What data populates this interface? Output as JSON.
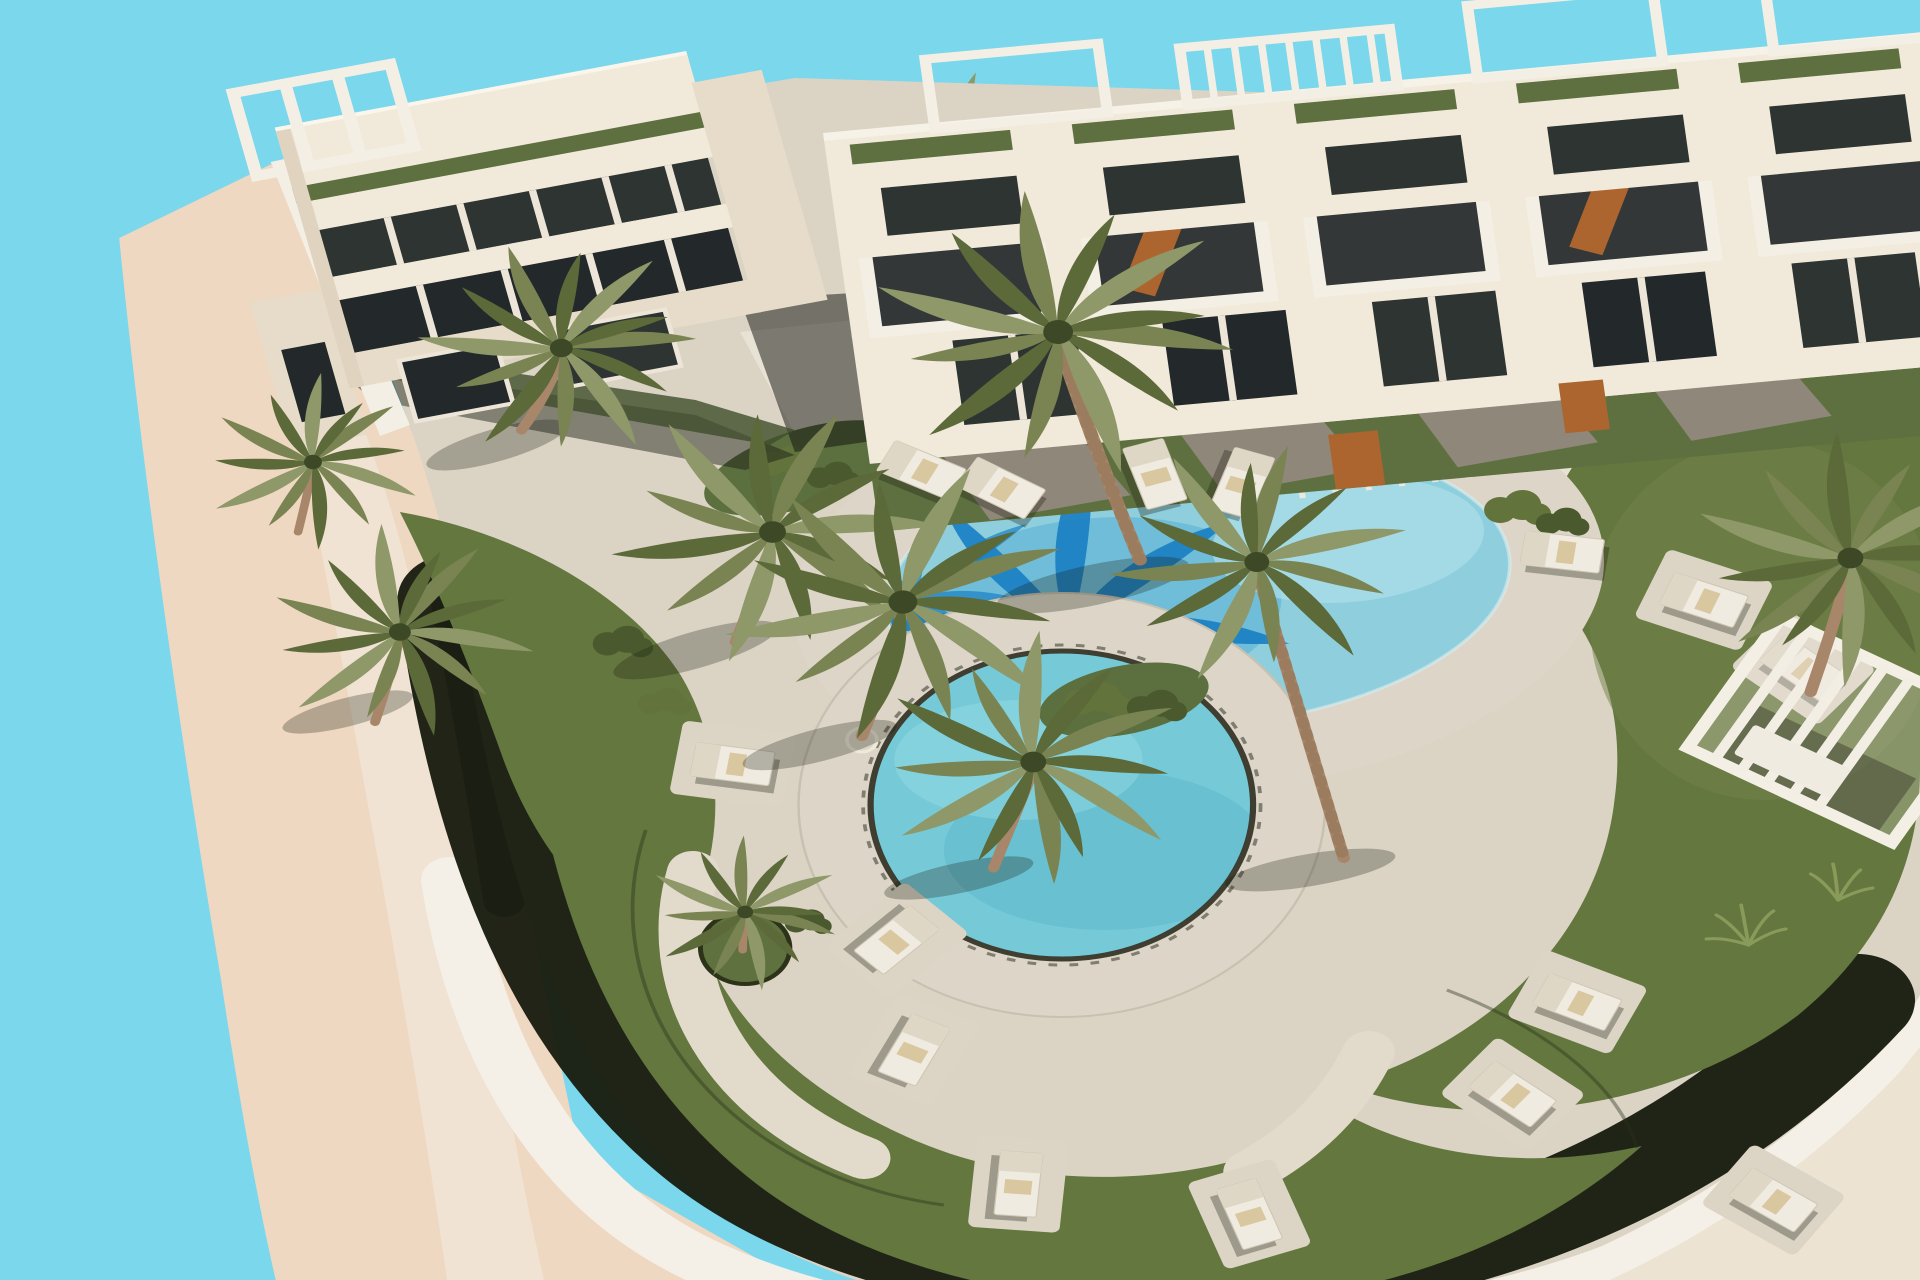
{
  "scene": {
    "type": "3d-architectural-render",
    "description": "Aerial 3D render of a modern white residential complex: two white apartment buildings with rooftop pergolas, a curved pool terrace with a large lagoon pool and a round pool, palm trees, green lawns, white sun loungers and a pale pink access road, all against a flat cyan sky background",
    "elements": {
      "buildings": 2,
      "pools": 2,
      "palm_trees": 13,
      "sun_loungers": 15,
      "pergolas": 5
    }
  },
  "colors": {
    "sky": "#7AD7EC",
    "road": "#EFD8C1",
    "roadLight": "#F0E5D6",
    "outside": "#EDE3D3",
    "rim": "#F4F0E7",
    "deck": "#DBD4C5",
    "deckLight": "#DDD6C8",
    "dark": "#1A1E11",
    "navy": "#2A2E3E",
    "grass": "#64773F",
    "bed": "#5C6F3F",
    "pool": "#8FCFDD",
    "poolShadow": "#1B80C4",
    "poolRound": "#76CAD8",
    "poolRim": "#2E2D1F",
    "white": "#F4EFE5",
    "facade": "#F1EADB",
    "facadeShade": "#E6DCC9",
    "window": "#2E3431",
    "windowDeep": "#23282A",
    "wood": "#AC652F",
    "patio": "#8F877A",
    "greenRoof": "#5E6F40",
    "hedge": "#46552C",
    "trunk": "#A8866A",
    "frond1": "#7A8452",
    "frond2": "#5C6939",
    "frond3": "#8E9868",
    "frondCore": "#3C4826",
    "bush": "#4A5A2E",
    "pad": "#DCD5C6"
  }
}
